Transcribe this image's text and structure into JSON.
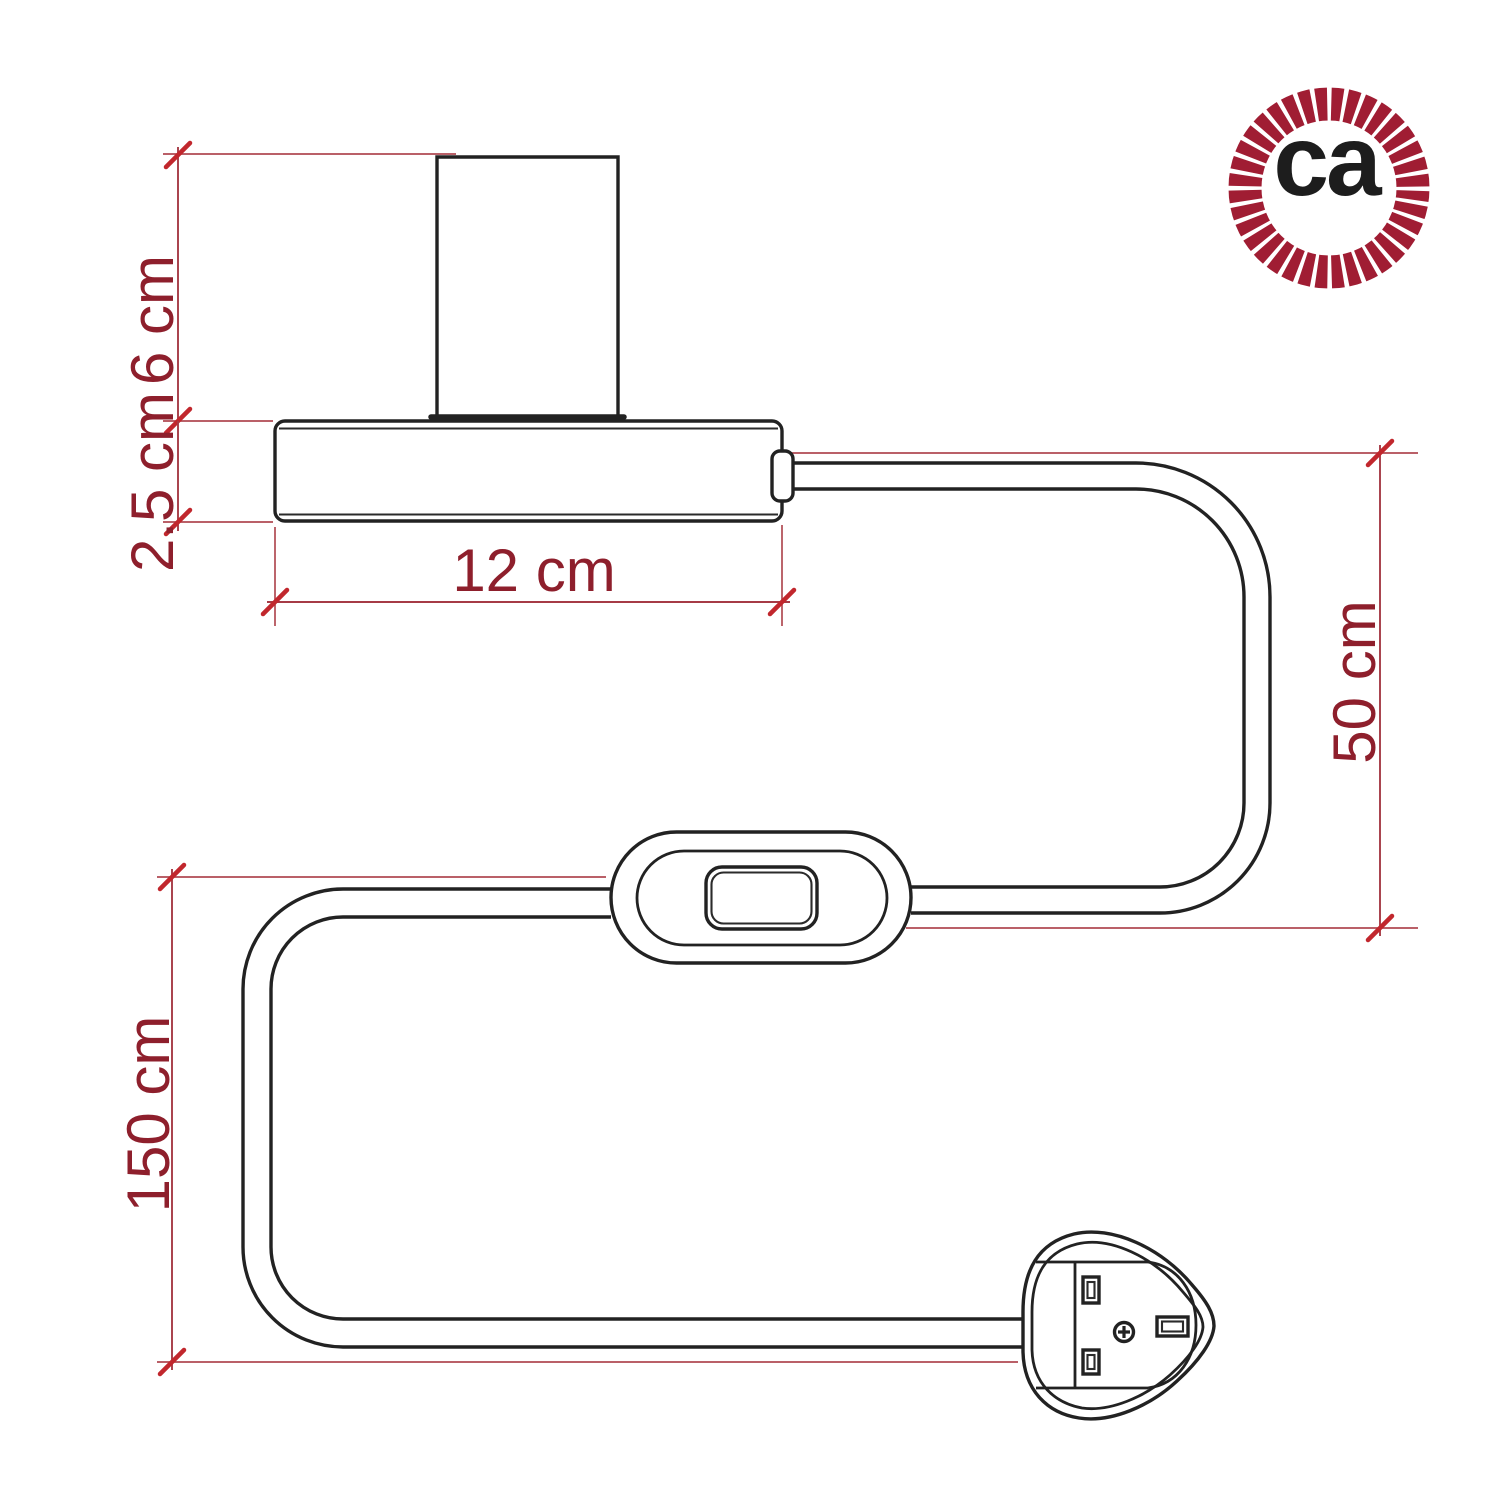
{
  "subject": "Dimensional line drawing of a cylindrical table lamp base with power cable, in-line switch and UK plug",
  "colors": {
    "background": "#ffffff",
    "line_art": "#222222",
    "extension_line": "#b04a52",
    "dimension_line": "#a63b46",
    "tick": "#c1272d",
    "dimension_text": "#8e1f2c",
    "logo_ring": "#a01d33",
    "logo_text": "#1d1d1d"
  },
  "dimensions": {
    "lamp_height": "6 cm",
    "base_height": "2.5 cm",
    "base_width": "12 cm",
    "cable_lamp_to_switch": "50 cm",
    "cable_switch_to_plug": "150 cm"
  },
  "logo": {
    "text": "ca"
  }
}
